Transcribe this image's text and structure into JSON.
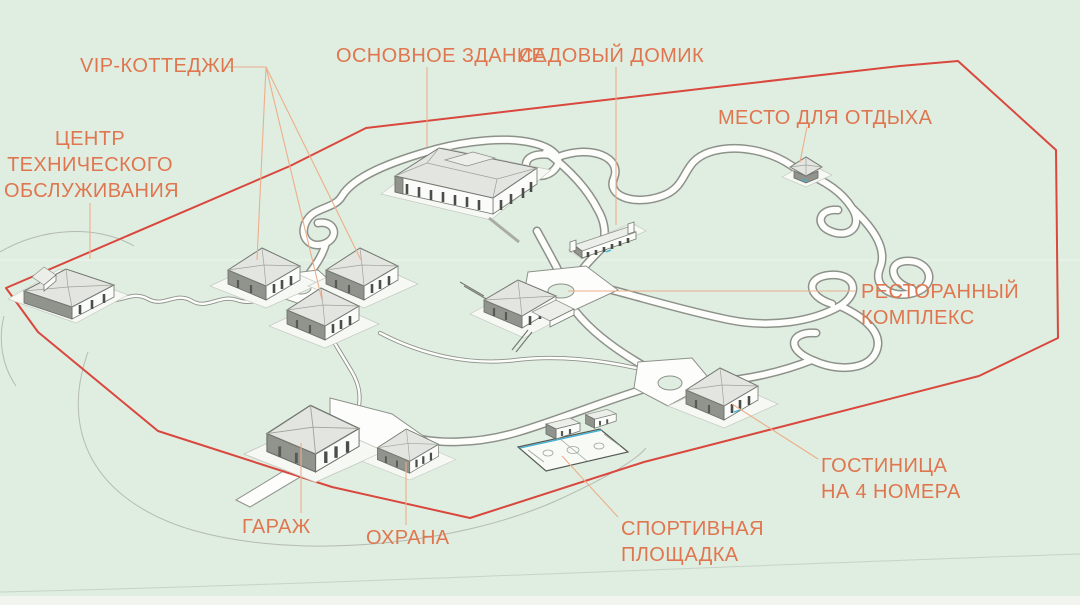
{
  "labels": {
    "vip": "VIP-КОТТЕДЖИ",
    "main_building": "ОСНОВНОЕ ЗДАНИЕ",
    "garden_house": "САДОВЫЙ ДОМИК",
    "rest_area": "МЕСТО ДЛЯ ОТДЫХА",
    "service_center": {
      "lines": [
        "ЦЕНТР",
        "ТЕХНИЧЕСКОГО",
        "ОБСЛУЖИВАНИЯ"
      ]
    },
    "restaurant": {
      "lines": [
        "РЕСТОРАННЫЙ",
        "КОМПЛЕКС"
      ]
    },
    "hotel": {
      "lines": [
        "ГОСТИНИЦА",
        "НА 4 НОМЕРА"
      ]
    },
    "garage": "ГАРАЖ",
    "security": "ОХРАНА",
    "sports": {
      "lines": [
        "СПОРТИВНАЯ",
        "ПЛОЩАДКА"
      ]
    }
  },
  "palette": {
    "background": "#DFEEE1",
    "label-text": "#E0764F",
    "leader": "#EDAE8A",
    "boundary": "#D9473D",
    "road-edge": "#8E918A",
    "road-fill": "#FDFEFB",
    "pad": "#F6F8F4",
    "roof": "#E3E5E0",
    "wall": "#FBFBF9",
    "wall-dark": "#90948C",
    "contour": "#AEB1AA",
    "court-blue": "#3FB0D4",
    "win": "#4A4E48"
  }
}
